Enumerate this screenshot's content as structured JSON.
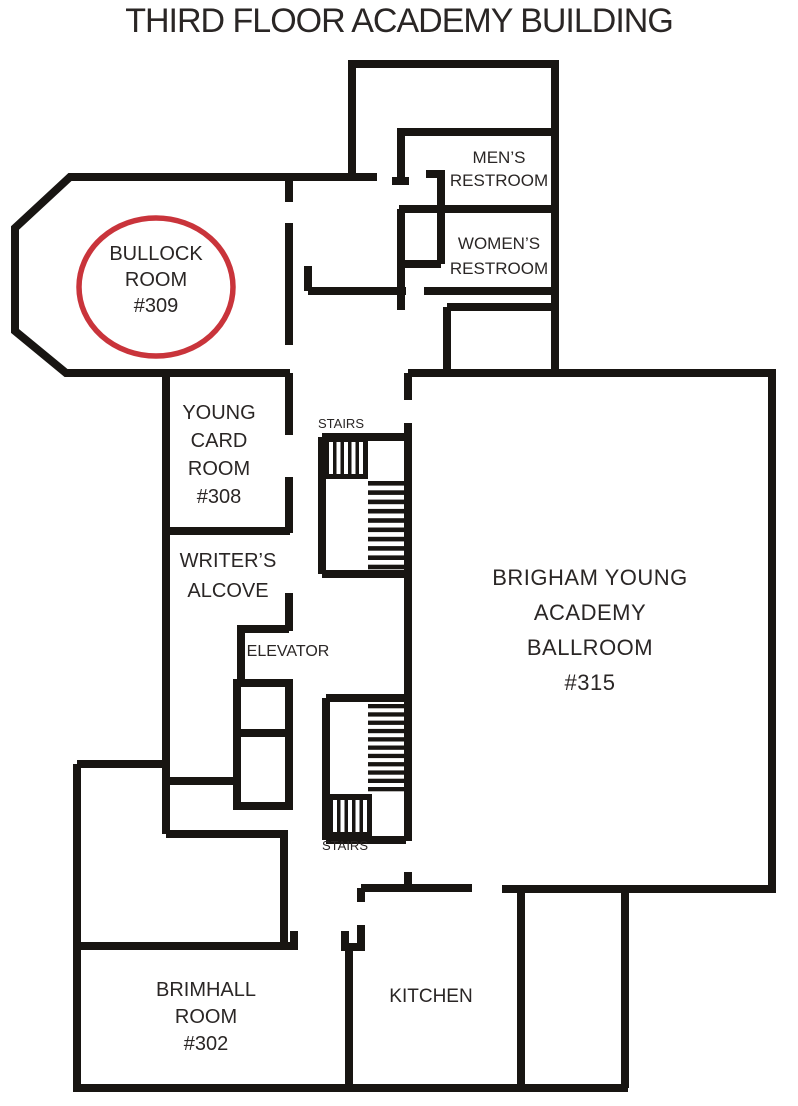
{
  "title": "THIRD FLOOR ACADEMY BUILDING",
  "colors": {
    "wall": "#181512",
    "text": "#2a2625",
    "background": "#ffffff"
  },
  "highlight": {
    "shape": "ellipse",
    "color": "#c9343b",
    "room": "BULLOCK ROOM #309"
  },
  "rooms": {
    "bullock_room": {
      "lines": [
        "BULLOCK",
        "ROOM",
        "#309"
      ]
    },
    "young_card_room": {
      "lines": [
        "YOUNG",
        "CARD",
        "ROOM",
        "#308"
      ]
    },
    "writers_alcove": {
      "lines": [
        "WRITER’S",
        "ALCOVE"
      ]
    },
    "mens_restroom": {
      "lines": [
        "MEN’S",
        "RESTROOM"
      ]
    },
    "womens_restroom": {
      "lines": [
        "WOMEN’S",
        "RESTROOM"
      ]
    },
    "ballroom": {
      "lines": [
        "BRIGHAM YOUNG",
        "ACADEMY",
        "BALLROOM",
        "#315"
      ]
    },
    "brimhall_room": {
      "lines": [
        "BRIMHALL",
        "ROOM",
        "#302"
      ]
    },
    "kitchen": {
      "label": "KITCHEN"
    },
    "elevator": {
      "label": "ELEVATOR"
    },
    "stairs_upper": {
      "label": "STAIRS"
    },
    "stairs_lower": {
      "label": "STAIRS"
    }
  }
}
